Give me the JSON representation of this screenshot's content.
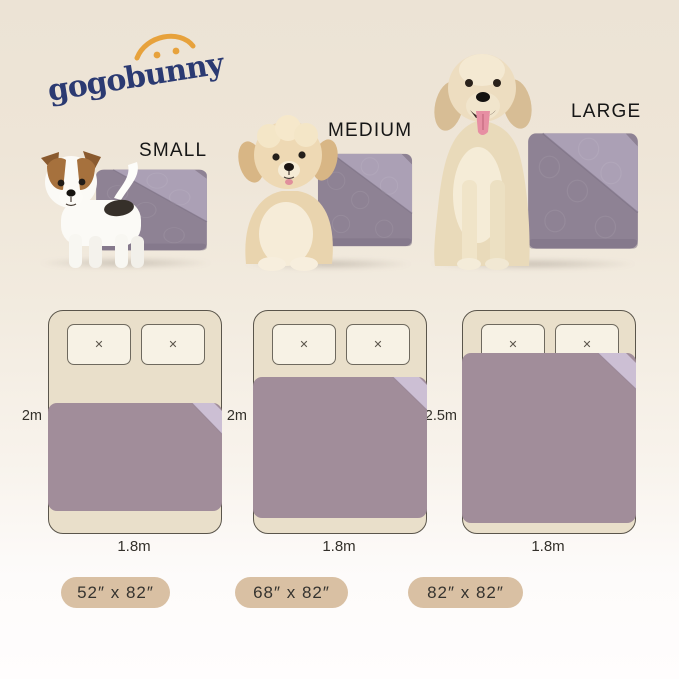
{
  "brand": {
    "name": "gogobunny"
  },
  "products": [
    {
      "size_label": "SMALL",
      "dimensions_badge": "52″ x 82″",
      "bed_length": "2m",
      "bed_width": "1.8m"
    },
    {
      "size_label": "MEDIUM",
      "dimensions_badge": "68″ x 82″",
      "bed_length": "2m",
      "bed_width": "1.8m"
    },
    {
      "size_label": "LARGE",
      "dimensions_badge": "82″ x 82″",
      "bed_length": "2.5m",
      "bed_width": "1.8m"
    }
  ],
  "icons": {
    "pillow_cross": "✕"
  },
  "colors": {
    "background_top": "#ece3d5",
    "background_bottom": "#fffdfd",
    "logo_text": "#2b3a72",
    "logo_arc": "#e7a23c",
    "blanket_dark": "#a18d9a",
    "blanket_fold_light": "#ccbfd4",
    "product_blanket_dark": "#8e8294",
    "product_blanket_light": "#aba0b5",
    "bed_fill": "#e9dfca",
    "bed_border": "#5a554b",
    "pillow_fill": "#f7f2e5",
    "badge_fill": "#d9c0a3",
    "label_text": "#161616"
  }
}
